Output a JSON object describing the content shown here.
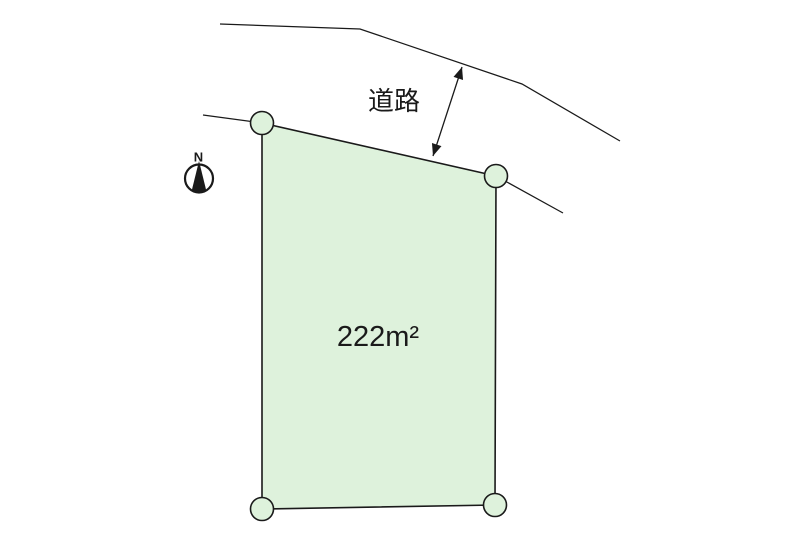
{
  "diagram": {
    "road": {
      "label": "道路"
    },
    "parcel": {
      "area_text": "222m²"
    },
    "compass": {
      "north_label": "N"
    },
    "colors": {
      "parcel_fill": "#def2dc",
      "line": "#1a1a1a",
      "background": "#ffffff"
    }
  }
}
